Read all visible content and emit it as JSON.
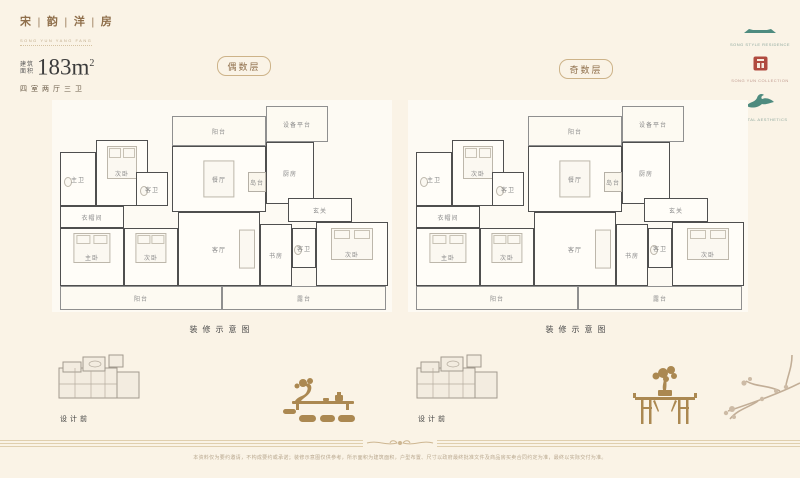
{
  "header": {
    "title": "宋 | 韵 | 洋 | 房",
    "subtitle": "SONG YUN YANG FANG",
    "area_label_top": "建筑",
    "area_label_bottom": "面积",
    "area_value": "183m",
    "area_sup": "2",
    "spec": "四室两厅三卫"
  },
  "badges": {
    "even": "偶数层",
    "odd": "奇数层"
  },
  "logos": [
    {
      "name": "roof-logo",
      "caption": "SONG STYLE RESIDENCE"
    },
    {
      "name": "seal-logo",
      "caption": "SONG YUN COLLECTION"
    },
    {
      "name": "crane-logo",
      "caption": "ORIENTAL AESTHETICS"
    }
  ],
  "floorplan": {
    "caption": "装修示意图",
    "rooms": [
      {
        "id": "equipment-platform",
        "label": "设备平台",
        "x": 214,
        "y": 6,
        "w": 62,
        "h": 36,
        "light": true
      },
      {
        "id": "balcony-top",
        "label": "阳台",
        "x": 120,
        "y": 16,
        "w": 94,
        "h": 30,
        "light": true
      },
      {
        "id": "master-bath",
        "label": "主卫",
        "x": 8,
        "y": 52,
        "w": 36,
        "h": 54,
        "furniture": "wc"
      },
      {
        "id": "bedroom-top",
        "label": "次卧",
        "x": 44,
        "y": 40,
        "w": 52,
        "h": 66,
        "furniture": "bed"
      },
      {
        "id": "guest-bath-top",
        "label": "客卫",
        "x": 84,
        "y": 72,
        "w": 32,
        "h": 34,
        "furniture": "wc"
      },
      {
        "id": "dining-room",
        "label": "餐厅",
        "x": 120,
        "y": 46,
        "w": 94,
        "h": 66,
        "furniture": "table"
      },
      {
        "id": "island-counter",
        "label": "岛台",
        "x": 196,
        "y": 72,
        "w": 18,
        "h": 20,
        "open": true
      },
      {
        "id": "kitchen",
        "label": "厨房",
        "x": 214,
        "y": 42,
        "w": 48,
        "h": 62
      },
      {
        "id": "cloakroom",
        "label": "衣帽间",
        "x": 8,
        "y": 106,
        "w": 64,
        "h": 22
      },
      {
        "id": "foyer",
        "label": "玄关",
        "x": 236,
        "y": 98,
        "w": 64,
        "h": 24
      },
      {
        "id": "master-bedroom",
        "label": "主卧",
        "x": 8,
        "y": 128,
        "w": 64,
        "h": 58,
        "furniture": "bed"
      },
      {
        "id": "bedroom-mid",
        "label": "次卧",
        "x": 72,
        "y": 128,
        "w": 54,
        "h": 58,
        "furniture": "bed"
      },
      {
        "id": "living-room",
        "label": "客厅",
        "x": 126,
        "y": 112,
        "w": 82,
        "h": 74,
        "furniture": "sofa"
      },
      {
        "id": "study",
        "label": "书房",
        "x": 208,
        "y": 124,
        "w": 32,
        "h": 62
      },
      {
        "id": "guest-bath-bottom",
        "label": "客卫",
        "x": 240,
        "y": 128,
        "w": 24,
        "h": 40,
        "furniture": "wc"
      },
      {
        "id": "bedroom-right",
        "label": "次卧",
        "x": 264,
        "y": 122,
        "w": 72,
        "h": 64,
        "furniture": "bed"
      },
      {
        "id": "balcony-bottom",
        "label": "阳台",
        "x": 8,
        "y": 186,
        "w": 162,
        "h": 24,
        "light": true
      },
      {
        "id": "terrace",
        "label": "露台",
        "x": 170,
        "y": 186,
        "w": 164,
        "h": 24,
        "light": true
      }
    ]
  },
  "thumbnails": {
    "label": "设计前"
  },
  "footer": {
    "disclaimer": "本资料仅为要约邀请，不构成要约或承诺；装修示意图仅供参考，所示面积为建筑面积，户型布置、尺寸以政府最终批准文件及商品房买卖合同约定为准，最终以实际交付为准。"
  },
  "colors": {
    "background": "#faf3e6",
    "title_brown": "#8f6f4b",
    "wall_dark": "#4f4f4f",
    "gold_decor": "#ab8851",
    "teal_logo": "#4e8b7f",
    "seal_red": "#b04a3f"
  }
}
